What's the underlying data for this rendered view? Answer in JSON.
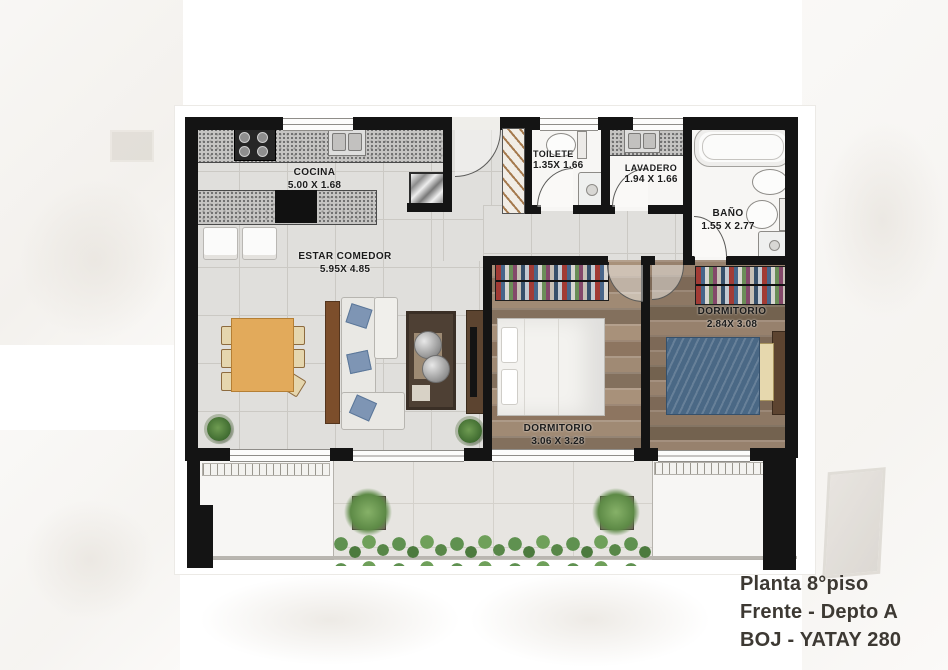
{
  "document_type": "apartment floor plan",
  "rooms": {
    "cocina": {
      "name": "COCINA",
      "dims": "5.00 X 1.68"
    },
    "estar": {
      "name": "ESTAR COMEDOR",
      "dims": "5.95X 4.85"
    },
    "toilete": {
      "name": "TOILETE",
      "dims": "1.35X 1.66"
    },
    "lavadero": {
      "name": "LAVADERO",
      "dims": "1.94 X 1.66"
    },
    "bano": {
      "name": "BAÑO",
      "dims": "1.55 X 2.77"
    },
    "dormitorio_1": {
      "name": "DORMITORIO",
      "dims": "3.06 X 3.28"
    },
    "dormitorio_2": {
      "name": "DORMITORIO",
      "dims": "2.84X 3.08"
    }
  },
  "title": {
    "line1": "Planta 8°piso",
    "line2": "Frente - Depto A",
    "line3": "BOJ - YATAY 280"
  },
  "colors": {
    "wall": "#141414",
    "tile_floor": "#e0dfdc",
    "balcony_tile": "#e7e5e1",
    "wood_floor_1": "#9c8874",
    "wood_floor_2": "#8f7a67",
    "granite_counter": "#c6c5c3",
    "bed_blue": "#4a6885",
    "dining_table": "#e2aa5b",
    "hedge_green": "#5f9150",
    "title_text": "#3d3933"
  }
}
